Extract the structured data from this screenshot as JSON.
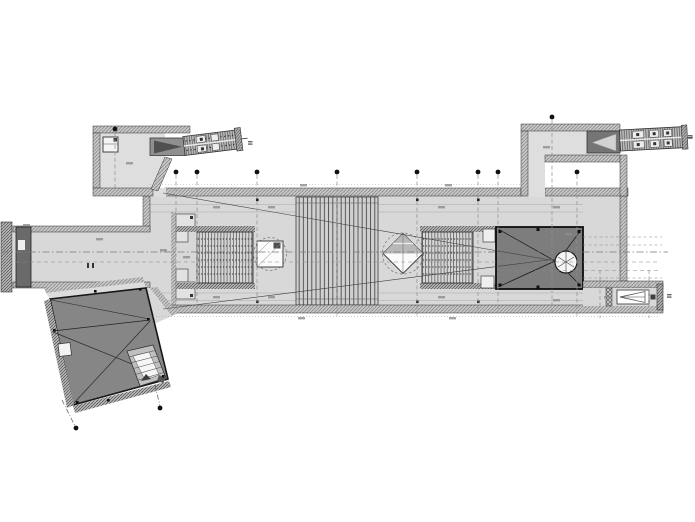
{
  "document": {
    "type": "technical-drawing",
    "subject": "metro station concourse level floor plan (CAD export)",
    "background": "#ffffff",
    "legible_text_present": false,
    "note": "all dimension and level annotations are below legibility; rendered as gray marks"
  },
  "colors": {
    "floor": "#d8d8d8",
    "floor_light": "#dedede",
    "void": "#7d7d7d",
    "pavilion": "#868686",
    "shaft": "#6a6a6a",
    "marker": "#111111",
    "line": "#3c3c3c"
  },
  "plan": {
    "grid_markers": [
      {
        "x": 115,
        "y": 129,
        "drop": 188
      },
      {
        "x": 176,
        "y": 172,
        "drop": 312
      },
      {
        "x": 197,
        "y": 172,
        "drop": 312
      },
      {
        "x": 257,
        "y": 172,
        "drop": 312
      },
      {
        "x": 337,
        "y": 172,
        "drop": 318
      },
      {
        "x": 417,
        "y": 172,
        "drop": 318
      },
      {
        "x": 478,
        "y": 172,
        "drop": 312
      },
      {
        "x": 498,
        "y": 172,
        "drop": 312
      },
      {
        "x": 552,
        "y": 117,
        "drop": 312
      },
      {
        "x": 577,
        "y": 172,
        "drop": 318
      },
      {
        "x": 76,
        "y": 428,
        "drop": null
      },
      {
        "x": 160,
        "y": 408,
        "drop": null
      }
    ],
    "dim_marks": [
      [
        213,
        206
      ],
      [
        268,
        206
      ],
      [
        438,
        206
      ],
      [
        553,
        206
      ],
      [
        213,
        296
      ],
      [
        268,
        296
      ],
      [
        438,
        296
      ],
      [
        553,
        299
      ],
      [
        298,
        317
      ],
      [
        449,
        317
      ],
      [
        160,
        249
      ],
      [
        183,
        256
      ],
      [
        126,
        162
      ],
      [
        543,
        146
      ],
      [
        23,
        224
      ],
      [
        96,
        238
      ],
      [
        565,
        233
      ],
      [
        604,
        296
      ],
      [
        445,
        184
      ],
      [
        300,
        184
      ]
    ],
    "tiny_labels": [
      [
        248,
        141
      ],
      [
        688,
        135
      ],
      [
        667,
        294
      ]
    ],
    "features": [
      {
        "name": "west-entrance",
        "role": "north-west entrance lobby with lift and escalator bank"
      },
      {
        "name": "east-entrance",
        "role": "north-east entrance lobby with escalator bank"
      },
      {
        "name": "south-entrance-pavilion",
        "role": "rotated secondary entrance pavilion with external stair"
      },
      {
        "name": "main-concourse",
        "role": "main concourse hall"
      },
      {
        "name": "central-grand-stair",
        "role": "full-width central stair / escalator band"
      },
      {
        "name": "west-stair-block",
        "role": "western stepped stair block"
      },
      {
        "name": "east-stair-block",
        "role": "eastern stepped stair block"
      },
      {
        "name": "skylight-square",
        "role": "square skylight opening over concourse"
      },
      {
        "name": "skylight-diamond",
        "role": "rotated diamond skylight opening"
      },
      {
        "name": "double-height-void",
        "role": "dark double-height void with spiral stair"
      },
      {
        "name": "west-link-corridor",
        "role": "west link corridor with service shaft"
      },
      {
        "name": "east-exit-corridor",
        "role": "east exit corridor with stair flight"
      },
      {
        "name": "grid-markers",
        "role": "survey grid markers with dashed section lines"
      },
      {
        "name": "sight-lines",
        "role": "diagonal sight/section lines crossing the hall"
      }
    ]
  }
}
